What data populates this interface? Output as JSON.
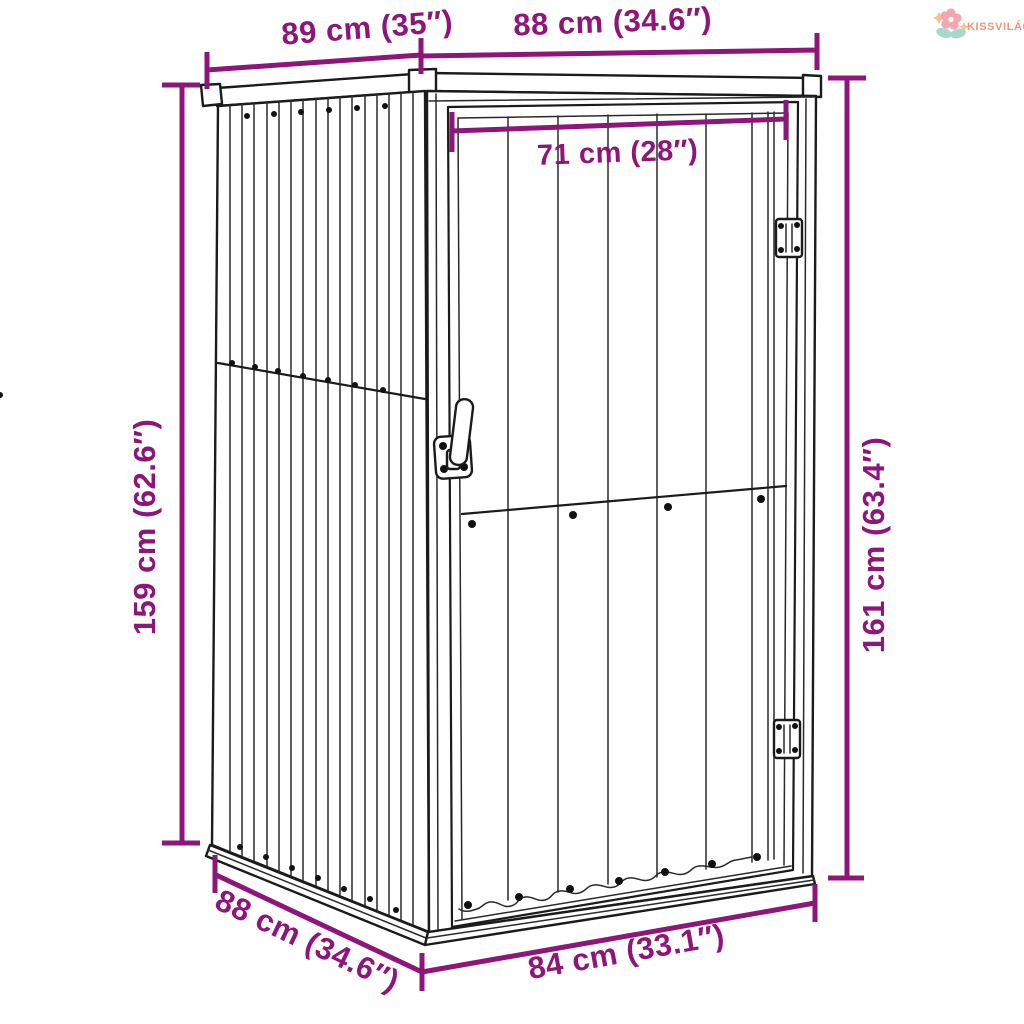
{
  "logo": {
    "text": "KISSVILÁG",
    "icon": "flower-icon",
    "text_color": "#f0957c",
    "petal_color": "#f2a6b4",
    "leaf_color": "#a8d8c6",
    "sparkle_color": "#f7c286"
  },
  "diagram": {
    "description": "Garden storage shed technical line drawing with dimension annotations",
    "line_color": "#1b1b1b",
    "dimension_color": "#8e1579",
    "dimensions": {
      "roof_depth": {
        "label": "89 cm (35″)"
      },
      "roof_width": {
        "label": "88 cm (34.6″)"
      },
      "door_width": {
        "label": "71 cm (28″)"
      },
      "height_back": {
        "label": "159 cm (62.6″)"
      },
      "height_front": {
        "label": "161 cm (63.4″)"
      },
      "base_depth": {
        "label": "88 cm (34.6″)"
      },
      "base_width": {
        "label": "84 cm (33.1″)"
      }
    }
  }
}
